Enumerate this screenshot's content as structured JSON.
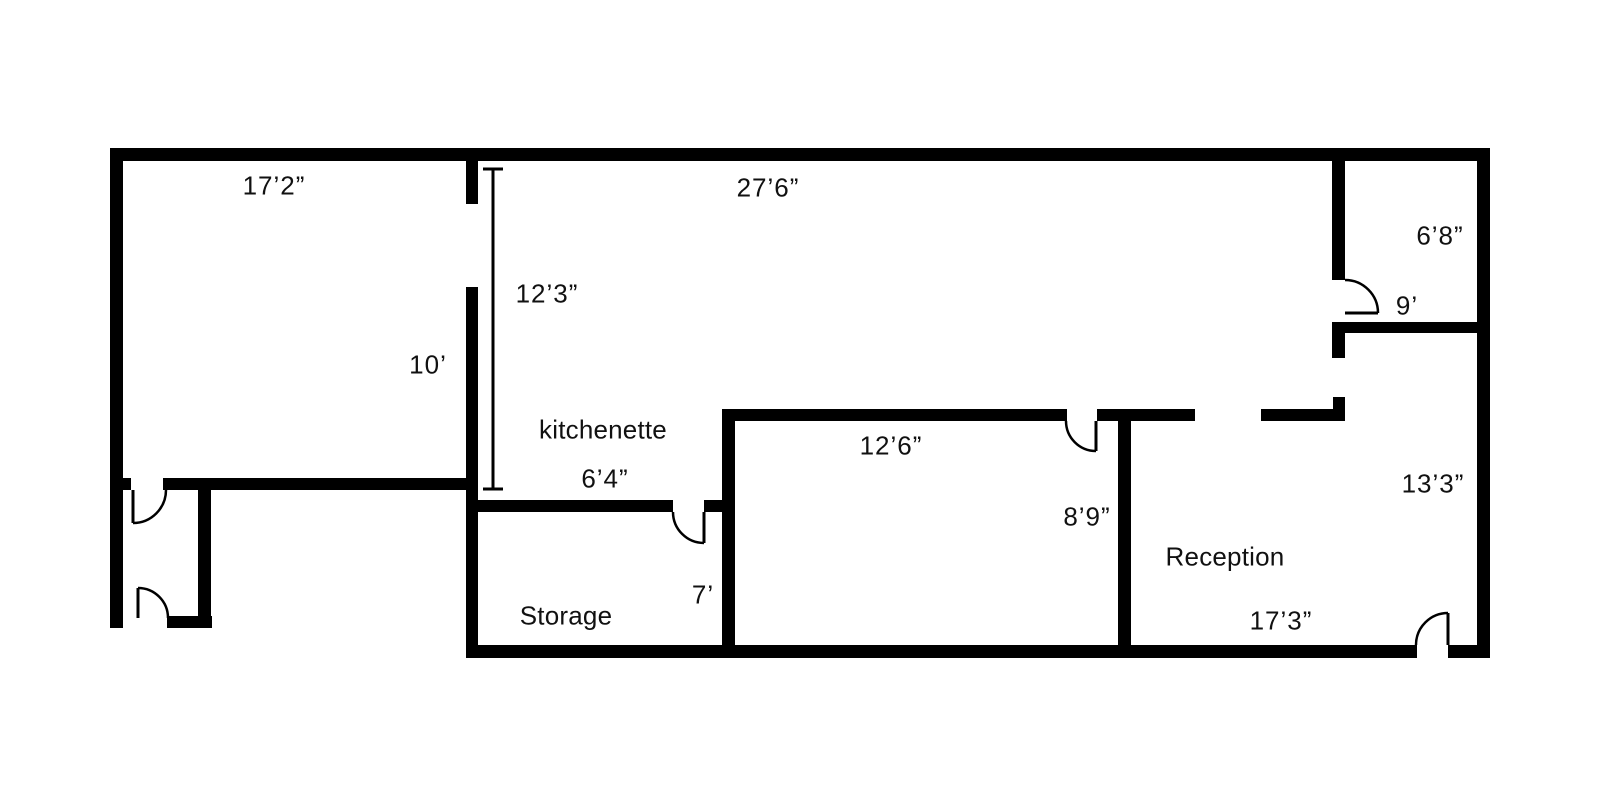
{
  "floorplan": {
    "colors": {
      "wall": "#000000",
      "background": "#ffffff",
      "text": "#111111"
    },
    "labels": {
      "room_kitchenette": "kitchenette",
      "room_storage": "Storage",
      "room_reception": "Reception",
      "dim_17_2": "17’2”",
      "dim_27_6": "27’6”",
      "dim_6_8": "6’8”",
      "dim_9": "9’",
      "dim_12_3": "12’3”",
      "dim_10": "10’",
      "dim_6_4": "6’4”",
      "dim_7": "7’",
      "dim_12_6": "12’6”",
      "dim_8_9": "8’9”",
      "dim_13_3": "13’3”",
      "dim_17_3": "17’3”"
    }
  }
}
